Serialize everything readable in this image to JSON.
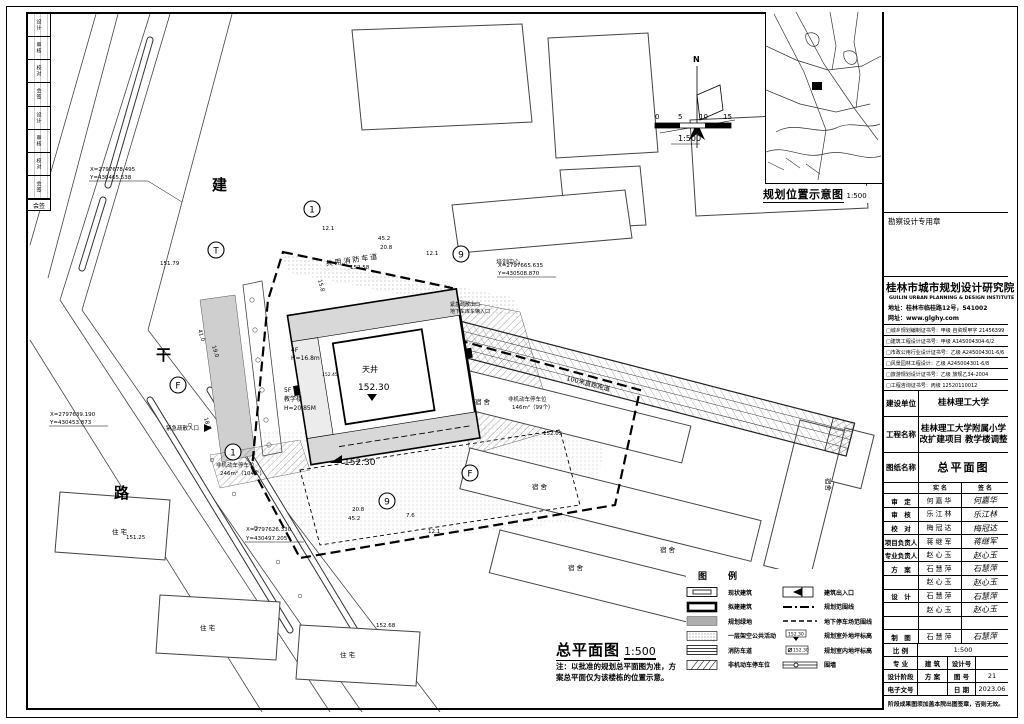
{
  "frame": {
    "sign_strip_rows": [
      "设计",
      "审核",
      "校对",
      "会签",
      "设计",
      "审核",
      "校对",
      "会签"
    ],
    "sign_strip_footer": "会签"
  },
  "location_map": {
    "title": "规划位置示意图",
    "scale": "1:500"
  },
  "stamp": {
    "label": "勘察设计专用章"
  },
  "title_block": {
    "institute_cn": "桂林市城市规划设计研究院",
    "institute_en": "GUILIN URBAN PLANNING & DESIGN INSTITUTE",
    "address": "地址：桂林市临桂路12号，541002",
    "website": "网址：www.glghy.com",
    "certs": [
      "□城乡规划编制证书号：甲级 自资规甲字 21456399",
      "□建筑工程设计证书号：甲级 A145004304-6/2",
      "□市政公用行业设计证书号：乙级 A245004301-6/6",
      "□风景园林工程设计：乙级 A245004301-6/8",
      "□旅游规划设计证书号：乙级 旅规乙34-2004",
      "□工程咨询证书号：丙级 12520110012"
    ],
    "owner_label": "建设单位",
    "owner_value": "桂林理工大学",
    "project_label": "工程名称",
    "project_value1": "桂林理工大学附属小学",
    "project_value2": "改扩建项目 教学楼调整",
    "sheet_label": "图纸名称",
    "sheet_value": "总平面图",
    "col_name": "实 名",
    "col_sign": "签 名",
    "rows": [
      {
        "role": "审　定",
        "name": "何嘉华",
        "sign": "何嘉华"
      },
      {
        "role": "审　核",
        "name": "乐江林",
        "sign": "乐江林"
      },
      {
        "role": "校　对",
        "name": "梅冠达",
        "sign": "梅冠达"
      },
      {
        "role": "项目负责人",
        "name": "蒋继军",
        "sign": "蒋继军"
      },
      {
        "role": "专业负责人",
        "name": "赵心玉",
        "sign": "赵心玉"
      },
      {
        "role": "方　案",
        "name": "石慧萍",
        "sign": "石慧萍"
      },
      {
        "role": "",
        "name": "赵心玉",
        "sign": "赵心玉"
      },
      {
        "role": "设　计",
        "name": "石慧萍",
        "sign": "石慧萍"
      },
      {
        "role": "",
        "name": "赵心玉",
        "sign": "赵心玉"
      },
      {
        "role": "",
        "name": "",
        "sign": ""
      },
      {
        "role": "制　图",
        "name": "石慧萍",
        "sign": "石慧萍"
      }
    ],
    "scale_label": "比 例",
    "scale_value": "1:500",
    "major_label": "专 业",
    "major_value": "建 筑",
    "design_no_label": "设计号",
    "design_no_value": "",
    "stage_label": "设计阶段",
    "stage_value": "方 案",
    "sheet_no_label": "图 号",
    "sheet_no_value": "21",
    "doc_no_label": "电子文号",
    "doc_no_value": "",
    "date_label": "日 期",
    "date_value": "2023.06",
    "footer": "阶段成果图须加盖本院出图签章，否则无效。"
  },
  "legend": {
    "title": "图　例",
    "left": [
      {
        "label": "现状建筑"
      },
      {
        "label": "拟建建筑"
      },
      {
        "label": "规划绿地"
      },
      {
        "label": "一层架空公共活动"
      },
      {
        "label": "消防车道"
      },
      {
        "label": "非机动车停车位"
      }
    ],
    "right": [
      {
        "label": "建筑出入口"
      },
      {
        "label": "规划范围线"
      },
      {
        "label": "地下停车场范围线"
      },
      {
        "label": "规划室外地坪标高"
      },
      {
        "label": "规划室内地坪标高"
      },
      {
        "label": "围墙"
      }
    ],
    "elev_sample": "152.30"
  },
  "plan": {
    "title": "总平面图",
    "scale": "1:500",
    "note1": "注：以批准的规划总平面图为准，方",
    "note2": "案总平面仅为该楼栋的位置示意。",
    "north": "N",
    "bar_ticks": {
      "t0": "0",
      "t1": "5",
      "t2": "10",
      "t3": "15"
    },
    "bar_scale": "1:500",
    "road": {
      "c1": "建",
      "c2": "干",
      "c3": "路"
    },
    "coords": {
      "nw1": "X=2797678.495",
      "nw2": "Y=430465.538",
      "w1": "X=2797639.190",
      "w2": "Y=430453.873",
      "ne1": "X=2797665.635",
      "ne2": "Y=430508.870",
      "s1": "X=2797626.330",
      "s2": "Y=430497.205"
    },
    "axis": {
      "a1": "1",
      "a9": "9",
      "f": "F",
      "t": "T"
    },
    "labels": {
      "fire_lane": "共用消防车道",
      "training": "培训中心",
      "courtyard": "天井",
      "fl4": "4F",
      "h4": "H=16.8m",
      "fl5": "5F",
      "school": "教学楼",
      "h5": "H=20.85M",
      "dorm": "宿舍",
      "home": "住宅",
      "track": "100米直跑跑道",
      "bike1a": "非机动车停车位",
      "bike1b": "146m²（99个）",
      "bike2a": "非机动车停车位",
      "bike2b": "246m²（104个）",
      "em_in": "紧急疏散入口",
      "em_out": "紧急疏散出口",
      "garage": "地下车库车辆入口"
    },
    "elev": {
      "e1": "152.30",
      "e2": "152.30",
      "e3": "152.58",
      "e4": "152.05",
      "e5": "152.68",
      "e6": "151.25",
      "e7": "151.79",
      "e8": "152.45"
    },
    "dims": {
      "d45a": "45.2",
      "d20a": "20.8",
      "d12a": "12.1",
      "d12b": "12.1",
      "d15": "15.8",
      "d41": "41.0",
      "d19": "19.0",
      "d18": "18.9",
      "d45b": "45.2",
      "d20b": "20.8",
      "d12c": "12.1",
      "d7": "7.6"
    }
  }
}
